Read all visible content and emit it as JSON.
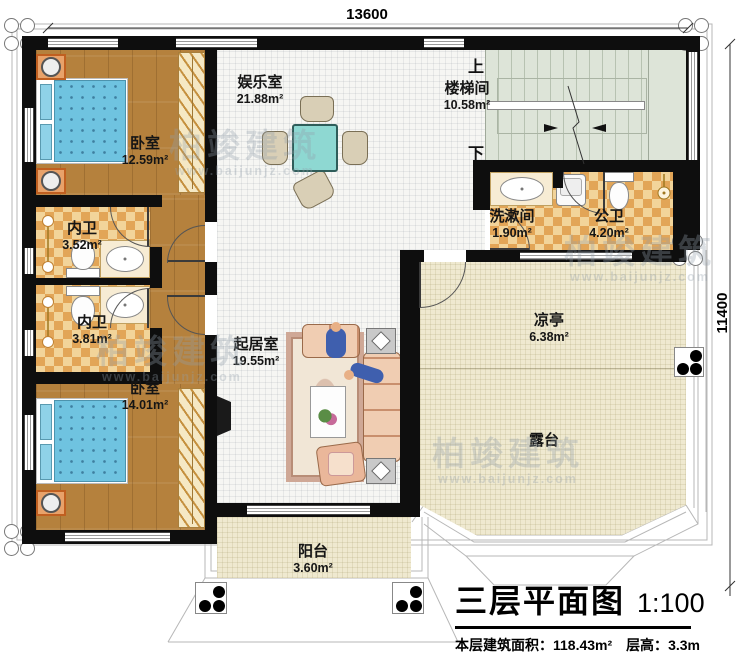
{
  "plan_title": {
    "name": "三层平面图",
    "scale": "1:100",
    "area_label": "本层建筑面积：",
    "area_value": "118.43m²",
    "height_label": "层高：",
    "height_value": "3.3m"
  },
  "dimensions": {
    "top": "13600",
    "right": "11400"
  },
  "rooms": [
    {
      "id": "bedroom-1",
      "name": "卧室",
      "area": "12.59m²"
    },
    {
      "id": "entertainment",
      "name": "娱乐室",
      "area": "21.88m²"
    },
    {
      "id": "stairwell",
      "name": "楼梯间",
      "area": "10.58m²"
    },
    {
      "id": "ensuite-1",
      "name": "内卫",
      "area": "3.52m²"
    },
    {
      "id": "ensuite-2",
      "name": "内卫",
      "area": "3.81m²"
    },
    {
      "id": "bedroom-2",
      "name": "卧室",
      "area": "14.01m²"
    },
    {
      "id": "washroom",
      "name": "洗漱间",
      "area": "1.90m²"
    },
    {
      "id": "public-bath",
      "name": "公卫",
      "area": "4.20m²"
    },
    {
      "id": "living-room",
      "name": "起居室",
      "area": "19.55m²"
    },
    {
      "id": "pavilion",
      "name": "凉亭",
      "area": "6.38m²"
    },
    {
      "id": "terrace",
      "name": "露台",
      "area": ""
    },
    {
      "id": "balcony",
      "name": "阳台",
      "area": "3.60m²"
    }
  ],
  "stairs": {
    "up": "上",
    "down": "下"
  },
  "watermark": {
    "brand": "柏竣建筑",
    "url": "www.baijunjz.com"
  },
  "colors": {
    "wall": "#0e0e0e",
    "wood": "#b5813d",
    "tile": "#e2a557",
    "stair": "#dde4d8",
    "terrace": "#efe9d0",
    "bed": "#6fc3e0",
    "mahjong_table": "#8ed8d2",
    "sofa": "#eab79a",
    "nightstand": "#e07b3c"
  }
}
